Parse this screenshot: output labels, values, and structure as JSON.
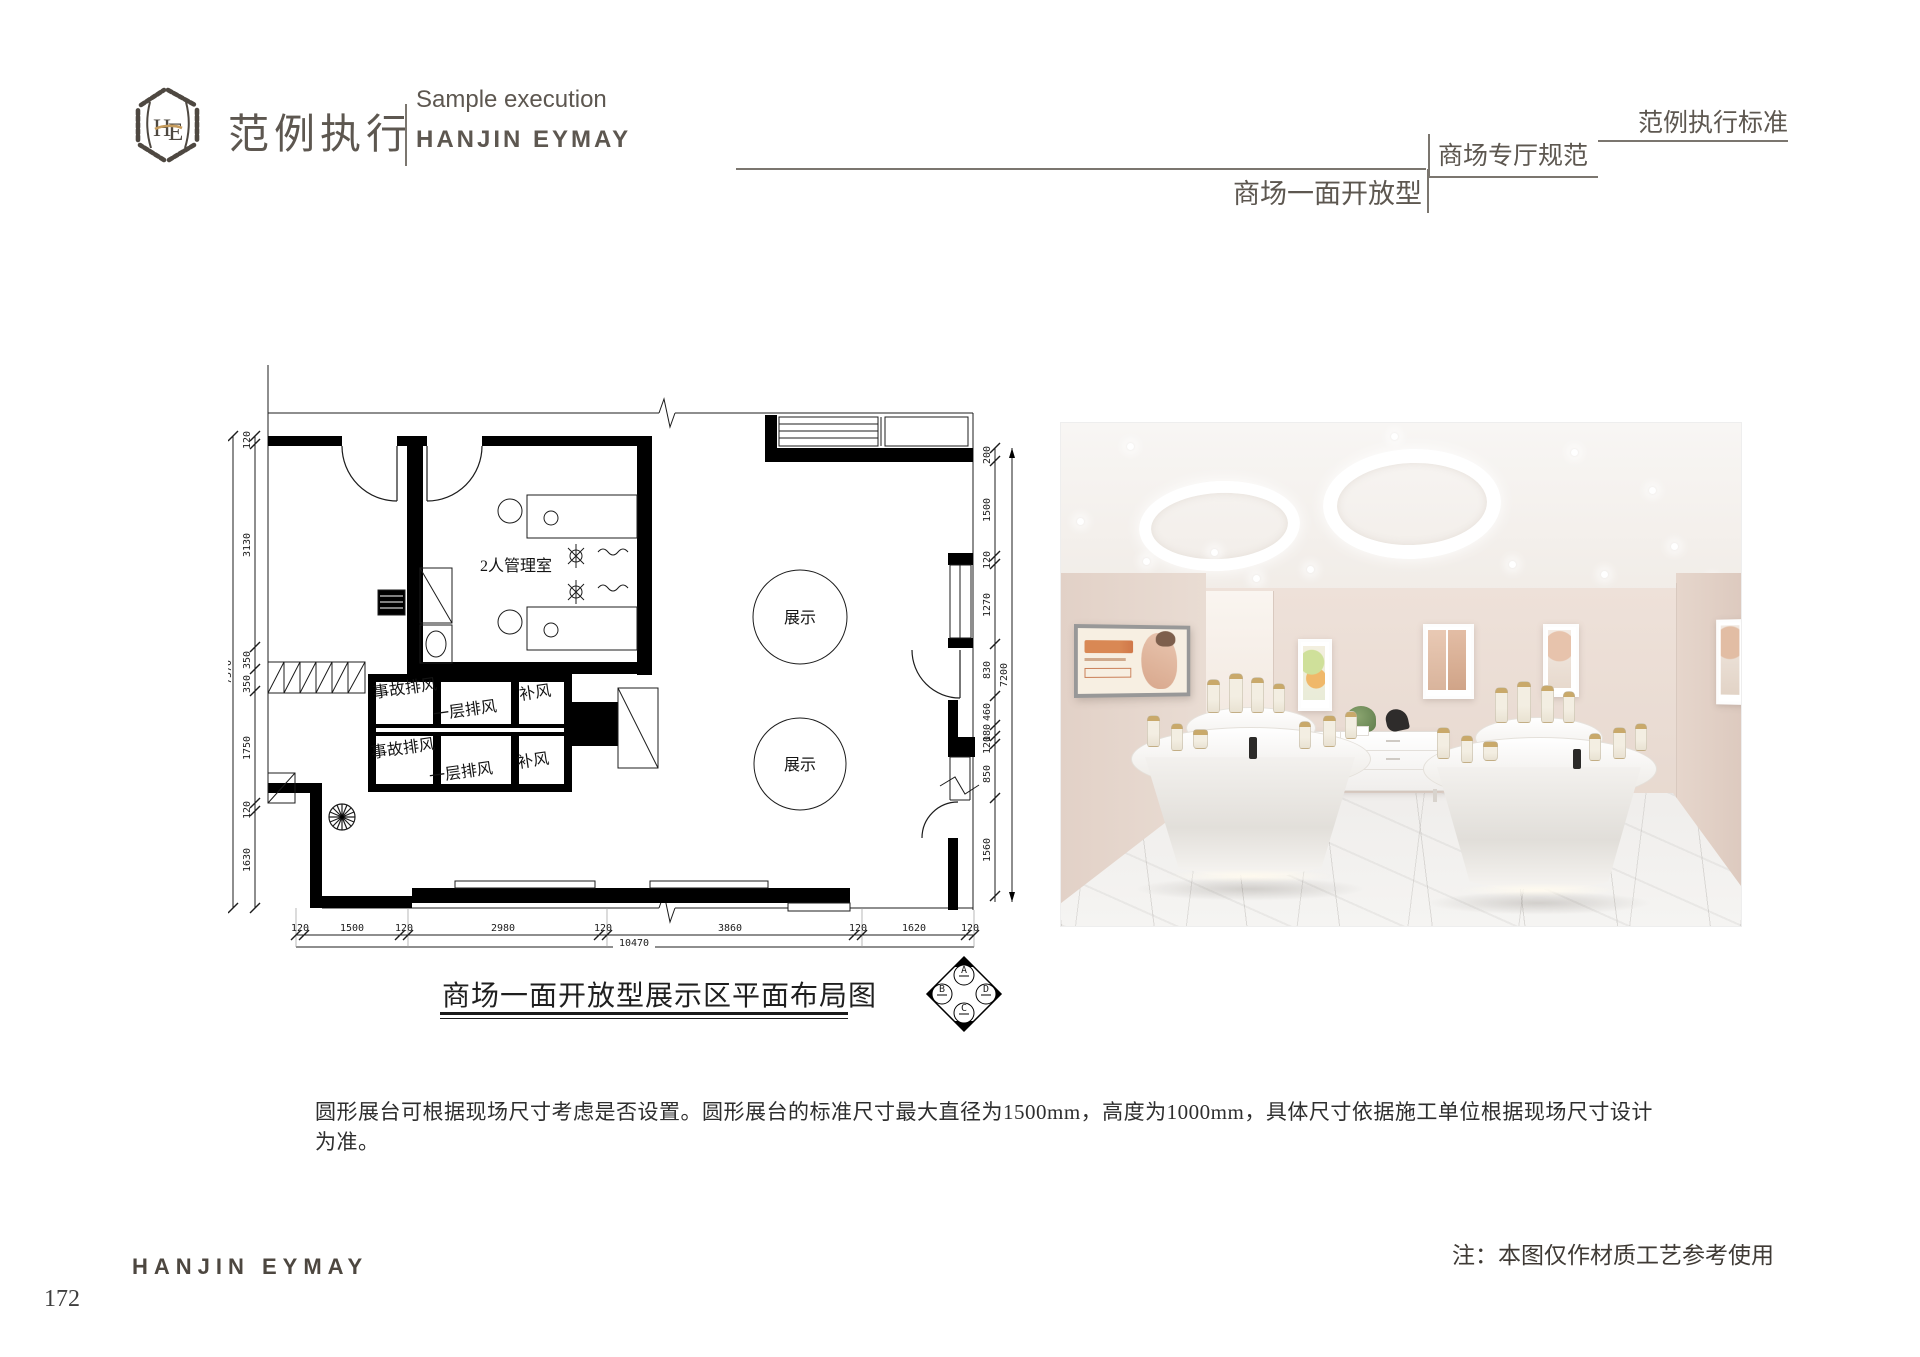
{
  "header": {
    "monogram": "HE",
    "brand_cn": "范例执行",
    "subtitle_en": "Sample execution",
    "brand_en": "HANJIN EYMAY",
    "standard_label": "范例执行标准",
    "section_label": "商场专厅规范",
    "page_type_label": "商场一面开放型"
  },
  "plan": {
    "caption": "商场一面开放型展示区平面布局图",
    "manager_room_label": "2人管理室",
    "display_label": "展示",
    "vent_row1": [
      "事故排风",
      "一层排风",
      "补风"
    ],
    "vent_row2": [
      "事故排风",
      "一层排风",
      "补风"
    ],
    "dims_left": [
      "120",
      "3130",
      "350",
      "350",
      "1750",
      "120",
      "1630"
    ],
    "dim_left_total": "7570",
    "dims_bottom": [
      "120",
      "1500",
      "120",
      "2980",
      "120",
      "3860",
      "120",
      "1620",
      "120"
    ],
    "dim_bottom_total": "10470",
    "dims_right": [
      "200",
      "1500",
      "120",
      "1270",
      "830",
      "460",
      "180",
      "120",
      "850",
      "1560"
    ],
    "dim_right_total": "7200",
    "compass_labels": [
      "A",
      "B",
      "C",
      "D"
    ]
  },
  "body": {
    "paragraph": "圆形展台可根据现场尺寸考虑是否设置。圆形展台的标准尺寸最大直径为1500mm，高度为1000mm，具体尺寸依据施工单位根据现场尺寸设计为准。"
  },
  "footer": {
    "note": "注：本图仅作材质工艺参考使用",
    "brand": "HANJIN EYMAY",
    "page_number": "172"
  },
  "colors": {
    "accent_gold": "#c69c5d",
    "ink": "#5d5750",
    "wall_beige": "#e9dcd3"
  }
}
